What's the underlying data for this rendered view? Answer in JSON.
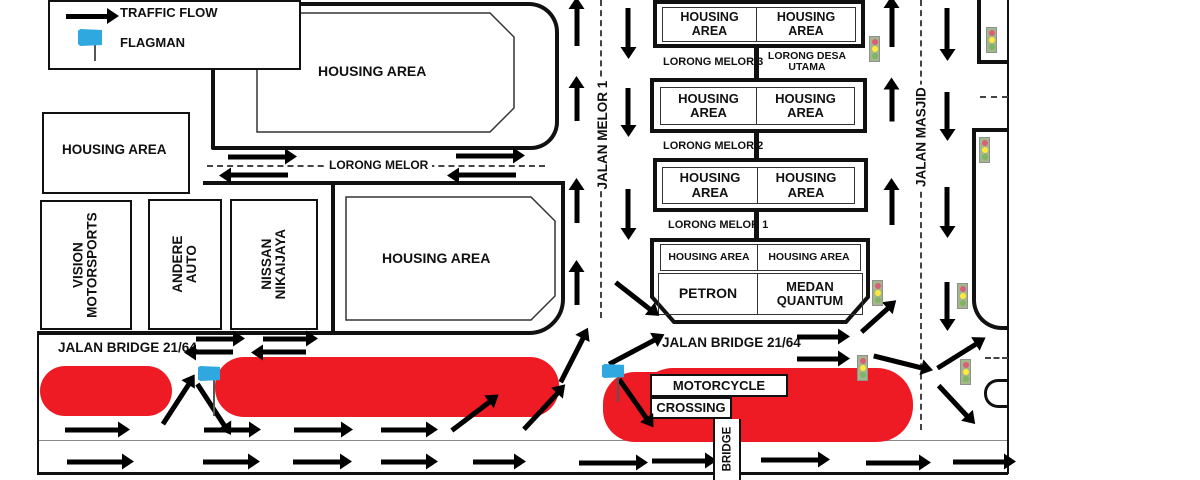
{
  "legend": {
    "traffic_flow_label": "TRAFFIC FLOW",
    "flagman_label": "FLAGMAN"
  },
  "areas": {
    "housing_top": "HOUSING AREA",
    "housing_left": "HOUSING AREA",
    "housing_mid": "HOUSING AREA",
    "business_1": "VISION MOTORSPORTS",
    "business_2": "ANDERE AUTO",
    "business_3": "NISSAN NIKAIJAYA"
  },
  "roads": {
    "jalan_melor_1": "JALAN MELOR 1",
    "jalan_masjid": "JALAN MASJID",
    "lorong_melor": "LORONG MELOR",
    "lorong_melor_3": "LORONG MELOR 3",
    "lorong_desa_utama": "LORONG DESA UTAMA",
    "lorong_melor_2": "LORONG MELOR 2",
    "lorong_melor_1": "LORONG MELOR 1",
    "jalan_bridge_left": "JALAN BRIDGE 21/64",
    "jalan_bridge_right": "JALAN BRIDGE 21/64",
    "bridge": "BRIDGE"
  },
  "blocks": {
    "housing_rows": [
      {
        "left": "HOUSING AREA",
        "right": "HOUSING AREA"
      },
      {
        "left": "HOUSING AREA",
        "right": "HOUSING AREA"
      },
      {
        "left": "HOUSING AREA",
        "right": "HOUSING AREA"
      },
      {
        "left": "HOUSING AREA",
        "right": "HOUSING AREA"
      }
    ],
    "petron": "PETRON",
    "medan_quantum": "MEDAN QUANTUM"
  },
  "crossing": {
    "line1": "MOTORCYCLE",
    "line2": "CROSSING"
  },
  "colors": {
    "closure_red": "#ee1b24",
    "flag_blue": "#2fa8e0",
    "traffic_light_body": "#a4b78b",
    "traffic_light_red": "#d95f78",
    "traffic_light_yellow": "#ffe93c",
    "traffic_light_green": "#7db465"
  }
}
